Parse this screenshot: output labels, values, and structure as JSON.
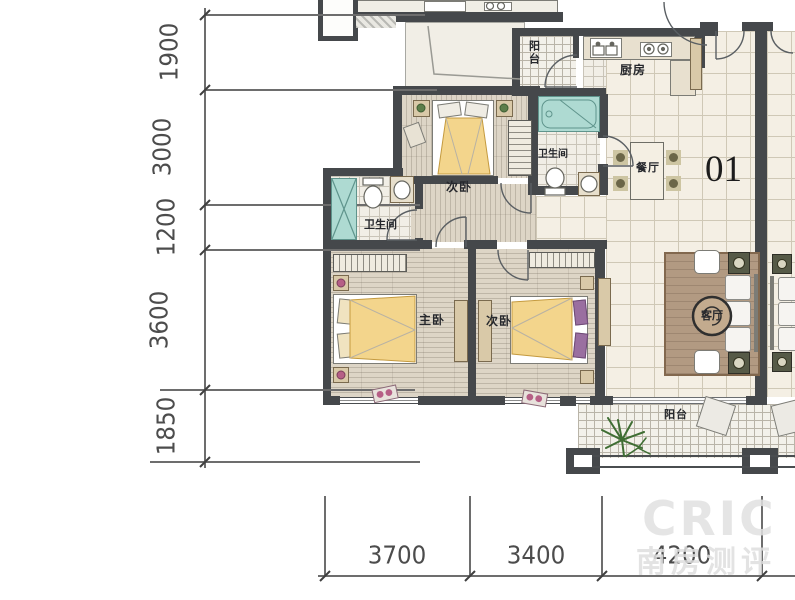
{
  "plan": {
    "unit_number": "01",
    "rooms": {
      "balcony_top": "阳台",
      "kitchen": "厨房",
      "dining": "餐厅",
      "bath_right": "卫生间",
      "bath_left": "卫生间",
      "bedroom_top": "次卧",
      "master": "主卧",
      "bedroom_bottom": "次卧",
      "living": "客厅",
      "balcony_bottom": "阳台"
    },
    "dimensions_left": [
      "1900",
      "3000",
      "1200",
      "3600",
      "1850"
    ],
    "dimensions_bottom": [
      "3700",
      "3400",
      "4200"
    ],
    "watermark": {
      "brand": "CRIC",
      "cn": "南房测评"
    },
    "colors": {
      "wall": "#45484b",
      "blanket_yellow": "#f3d58c",
      "fixture_teal": "#aedad2",
      "rug_brown": "#b29a82",
      "plant_green": "#3f6e33",
      "pillow_purple": "#9a6fa0",
      "floor_wood": "#ddd5c6",
      "floor_tile": "#f4efe4"
    }
  }
}
